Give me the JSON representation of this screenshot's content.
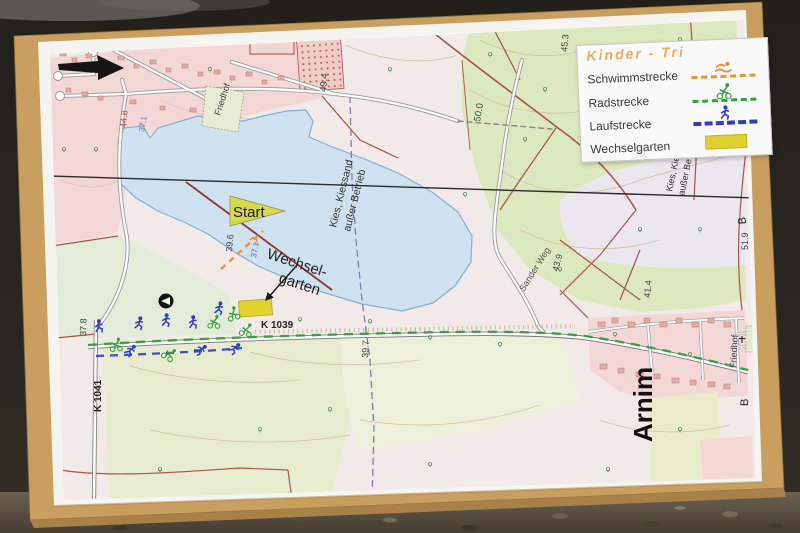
{
  "palette": {
    "background_top": "#23201c",
    "ground": "#554c3f",
    "board_wood": "#c99f5f",
    "paper": "#f6f4f0",
    "lake_fill": "#cfe1ee",
    "lake_edge": "#85b2d2",
    "urban_pink": "#f3d6d6",
    "forest_green": "#dce8bd",
    "road_red": "#a8524a",
    "swim_color": "#e8923a",
    "bike_color": "#33a03c",
    "run_color": "#2e3ec0",
    "wechselgarten_yellow": "#ddd02f"
  },
  "legend": {
    "title": "Kinder - Tri",
    "entries": [
      {
        "label": "Schwimmstrecke",
        "icon": "swimmer-icon",
        "color": "#e8923a"
      },
      {
        "label": "Radstrecke",
        "icon": "cyclist-icon",
        "color": "#33a03c"
      },
      {
        "label": "Laufstrecke",
        "icon": "runner-icon",
        "color": "#2e3ec0"
      },
      {
        "label": "Wechselgarten",
        "icon": "wechselgarten-swatch",
        "color": "#ddd02f"
      }
    ]
  },
  "map": {
    "labels": {
      "start": "Start",
      "wechsel_line1": "Wechsel-",
      "wechsel_line2": "garten",
      "town": "Arnim",
      "friedhof_right": "Friedhof",
      "friedhof_left": "Friedhof",
      "kies_center_line1": "Kies, Kiessand",
      "kies_center_line2": "außer Betrieb",
      "kies_right_line1": "Kies, Kie",
      "kies_right_line2": "außer Be",
      "sander_weg": "Sander Weg",
      "road_k1039": "K 1039",
      "road_k1041": "K 1041",
      "marker_b_north": "B",
      "marker_b_south": "B"
    },
    "elevations": {
      "e448": "44.8",
      "e371w": "37.1",
      "e494": "49.4",
      "e500": "50.0",
      "e453": "45.3",
      "e439": "43.9",
      "e414": "41.4",
      "e396": "39.6",
      "e371s": "37.1",
      "e397": "39.7",
      "e378": "37.8",
      "e519": "51.9"
    }
  }
}
